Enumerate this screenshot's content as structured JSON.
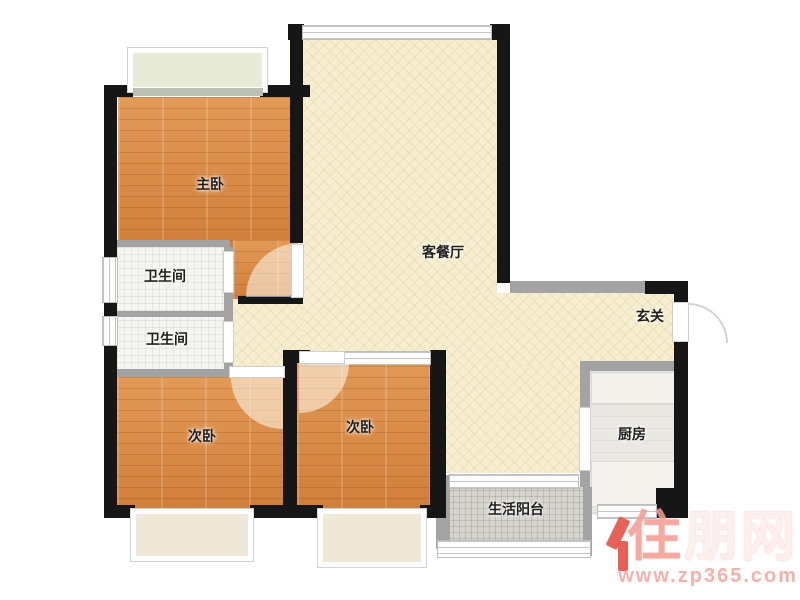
{
  "floorplan": {
    "rooms": {
      "master_bedroom": {
        "label": "主卧"
      },
      "bathroom_upper": {
        "label": "卫生间"
      },
      "bathroom_lower": {
        "label": "卫生间"
      },
      "bedroom_left": {
        "label": "次卧"
      },
      "bedroom_middle": {
        "label": "次卧"
      },
      "living_dining": {
        "label": "客餐厅"
      },
      "entrance": {
        "label": "玄关"
      },
      "kitchen": {
        "label": "厨房"
      },
      "balcony": {
        "label": "生活阳台"
      }
    },
    "watermark": {
      "brand_first_char": "住",
      "brand_rest": "朋网",
      "url": "www.zp365.com"
    },
    "colors": {
      "wall": "#161616",
      "partition_wall": "#a3a3a3",
      "wood_floor": "#d98844",
      "public_floor": "#f7eecf",
      "bathroom_floor": "#f4f4f1",
      "kitchen_floor": "#e9e8e3",
      "balcony_floor": "#d6d5cd",
      "watermark_red": "#e6544a"
    }
  }
}
